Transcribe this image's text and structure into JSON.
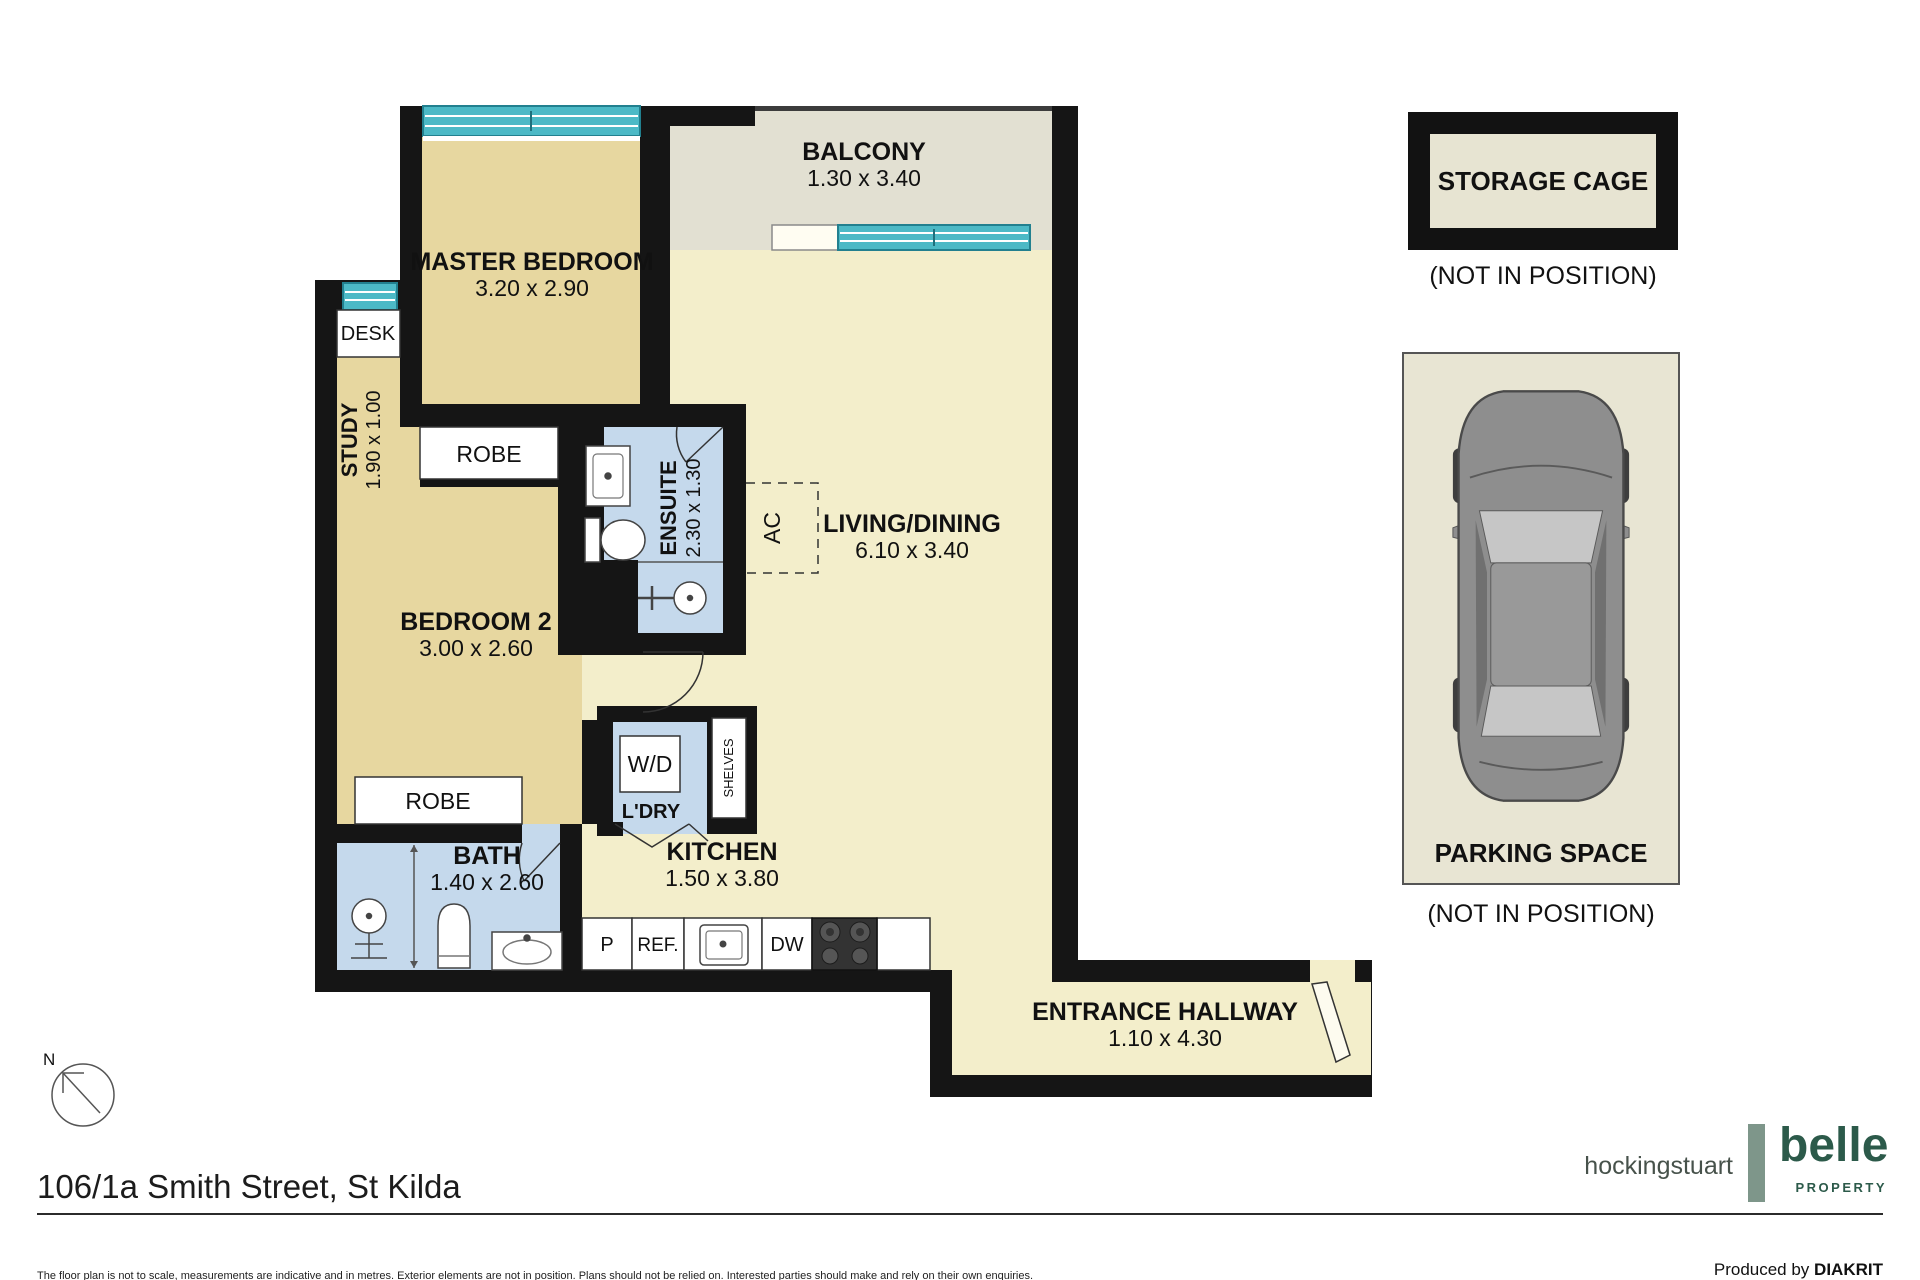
{
  "plan": {
    "master": {
      "name": "MASTER BEDROOM",
      "dims": "3.20 x 2.90"
    },
    "balcony": {
      "name": "BALCONY",
      "dims": "1.30 x 3.40"
    },
    "living": {
      "name": "LIVING/DINING",
      "dims": "6.10 x 3.40"
    },
    "bedroom2": {
      "name": "BEDROOM 2",
      "dims": "3.00 x 2.60"
    },
    "study": {
      "name": "STUDY",
      "dims": "1.90 x 1.00"
    },
    "ensuite": {
      "name": "ENSUITE",
      "dims": "2.30 x 1.30"
    },
    "bath": {
      "name": "BATH",
      "dims": "1.40 x 2.60"
    },
    "kitchen": {
      "name": "KITCHEN",
      "dims": "1.50 x 3.80"
    },
    "hallway": {
      "name": "ENTRANCE HALLWAY",
      "dims": "1.10 x 4.30"
    },
    "labels": {
      "desk": "DESK",
      "robe_master": "ROBE",
      "robe_bedroom2": "ROBE",
      "wd": "W/D",
      "ldry": "L'DRY",
      "shelves": "SHELVES",
      "pantry": "P",
      "fridge": "REF.",
      "dishwasher": "DW",
      "ac": "AC",
      "north": "N"
    }
  },
  "storage": {
    "label": "STORAGE CAGE",
    "note": "(NOT IN POSITION)"
  },
  "parking": {
    "label": "PARKING SPACE",
    "note": "(NOT IN POSITION)"
  },
  "footer": {
    "address": "106/1a Smith Street, St Kilda",
    "disclaimer": "The floor plan is not to scale, measurements are indicative and in metres. Exterior elements are not in position. Plans should not be relied on. Interested parties should make and rely on their own enquiries.",
    "produced_prefix": "Produced by",
    "producer": "DIAKRIT"
  },
  "brands": {
    "left": "hockingstuart",
    "right": "belle",
    "right_sub": "PROPERTY"
  },
  "colors": {
    "wall": "#151515",
    "floor_living": "#f3eecb",
    "floor_bedroom": "#e7d7a0",
    "wet_area": "#c5d9ec",
    "balcony": "#e2e0d2",
    "window": "#4cb9c6",
    "storage_fill": "#e7e4d2",
    "brand_green": "#2c5a4a",
    "brand_sage": "#7e968a"
  }
}
